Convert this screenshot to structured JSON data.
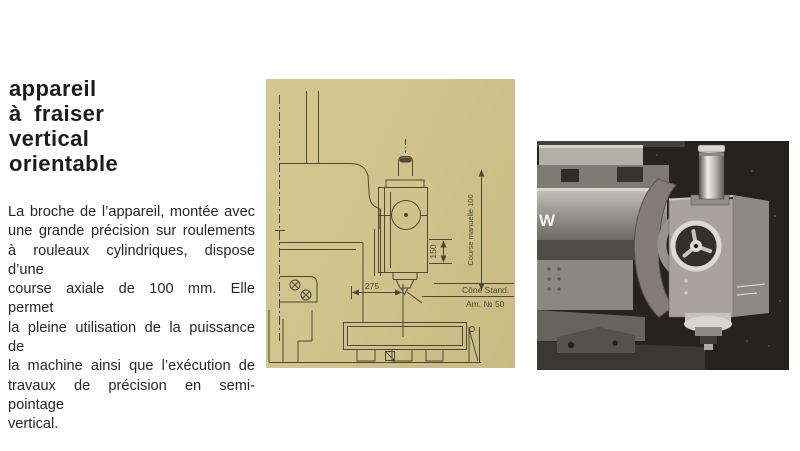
{
  "article": {
    "heading_lines": [
      "appareil",
      "à fraiser",
      "vertical",
      "orientable"
    ],
    "paragraph_lines": [
      "La broche de l’appareil, montée avec",
      "une grande précision sur roulements",
      "à rouleaux cylindriques, dispose d’une",
      "course axiale de 100 mm. Elle permet",
      "la pleine utilisation de la puissance de",
      "la machine ainsi que l’exécution de",
      "travaux de précision en semi-pointage",
      "vertical."
    ]
  },
  "drawing": {
    "background_color": "#cfc28a",
    "line_color": "#4d4936",
    "dimensions": {
      "horizontal": "275",
      "vertical": "150",
      "travel": "Course manuelle 100"
    },
    "taper_label": {
      "line1": "Cône Stand.",
      "line2": "Am. № 50"
    }
  },
  "photo": {
    "background_color": "#26231f",
    "logo_letter": "W"
  }
}
